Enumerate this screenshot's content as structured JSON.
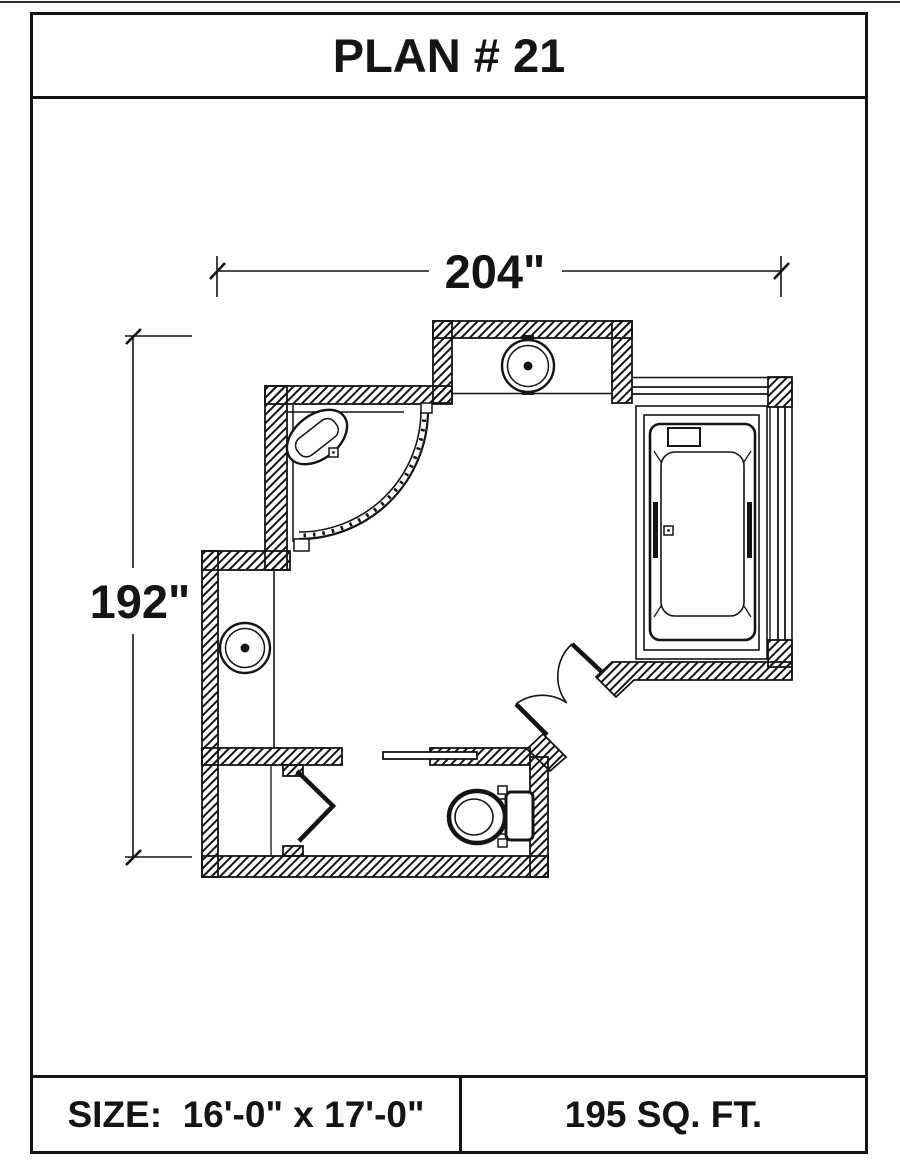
{
  "title": "PLAN # 21",
  "plan": {
    "width_label": "204\"",
    "height_label": "192\"",
    "line_color": "#141414",
    "background_color": "#ffffff"
  },
  "footer": {
    "size_label": "SIZE:  16'-0\" x 17'-0\"",
    "area_label": "195 SQ. FT."
  }
}
